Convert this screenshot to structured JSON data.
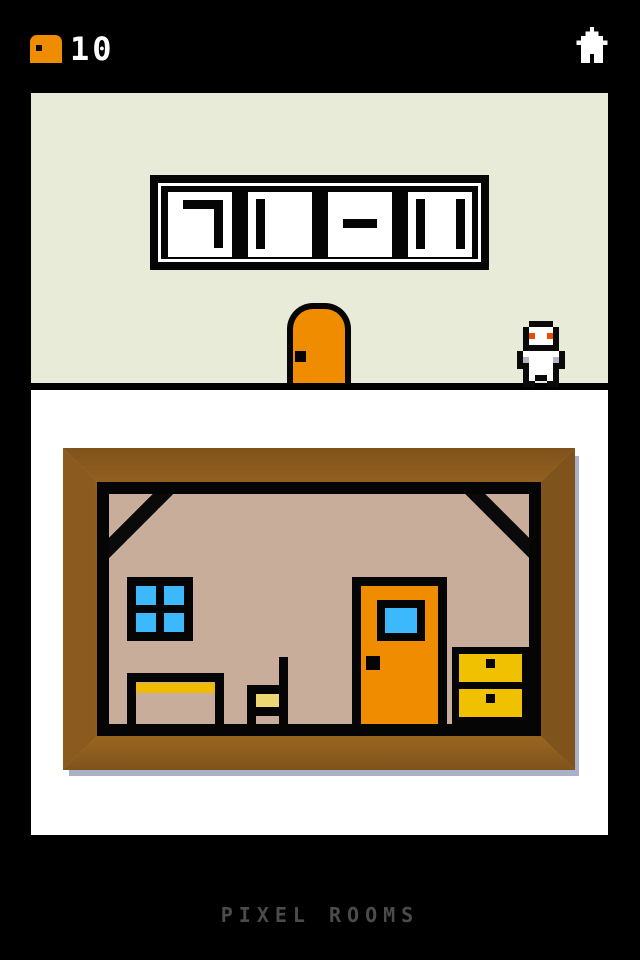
{
  "header": {
    "room_counter": "10",
    "door_icon": "door-icon",
    "home_icon": "home-icon"
  },
  "footer": {
    "app_title": "PIXEL ROOMS"
  },
  "sign": {
    "panel_symbols": [
      "top-right-corner",
      "vertical-bar-left",
      "horizontal-dash",
      "two-vertical-bars"
    ]
  },
  "scene": {
    "objects": [
      "clue-sign",
      "orange-door",
      "player-character"
    ],
    "picture_objects": [
      "window",
      "door",
      "dresser",
      "table",
      "chair"
    ]
  },
  "colors": {
    "accent_orange": "#f08c00",
    "beige": "#e9ebd9",
    "wall_tan": "#c8ad9b",
    "frame_wood": "#d79940",
    "window_blue": "#3bb9fc",
    "drawer_gold": "#f0c100",
    "table_gold": "#f0ba00",
    "chair_seat": "#eed573",
    "shadow_blue": "#aab1c6",
    "title_gray": "#4b4b4b",
    "eye": "#ea4d00"
  }
}
